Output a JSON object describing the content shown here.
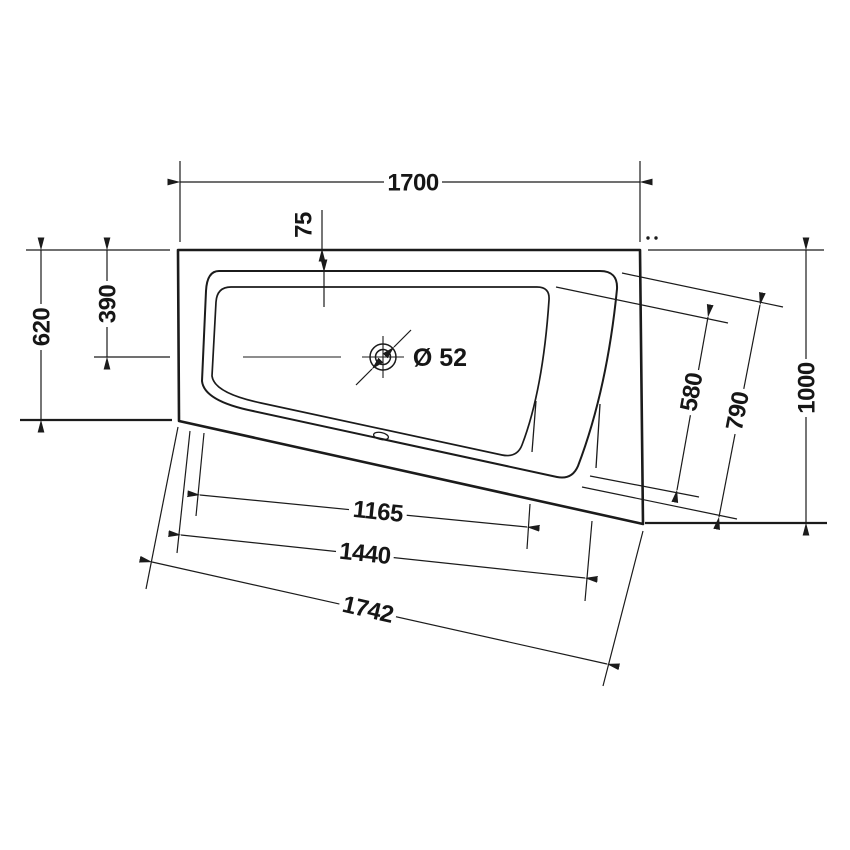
{
  "page": {
    "background": "#ffffff",
    "line_color": "#1b1b1b"
  },
  "drawing": {
    "labels": {
      "top_width": "1700",
      "rim_inset": "75",
      "left_total": "620",
      "left_to_drain": "390",
      "drain_diameter": "Ø 52",
      "right_inner": "580",
      "right_outer": "790",
      "side_total": "1000",
      "front_inner": "1165",
      "front_middle": "1440",
      "front_total": "1742"
    }
  }
}
